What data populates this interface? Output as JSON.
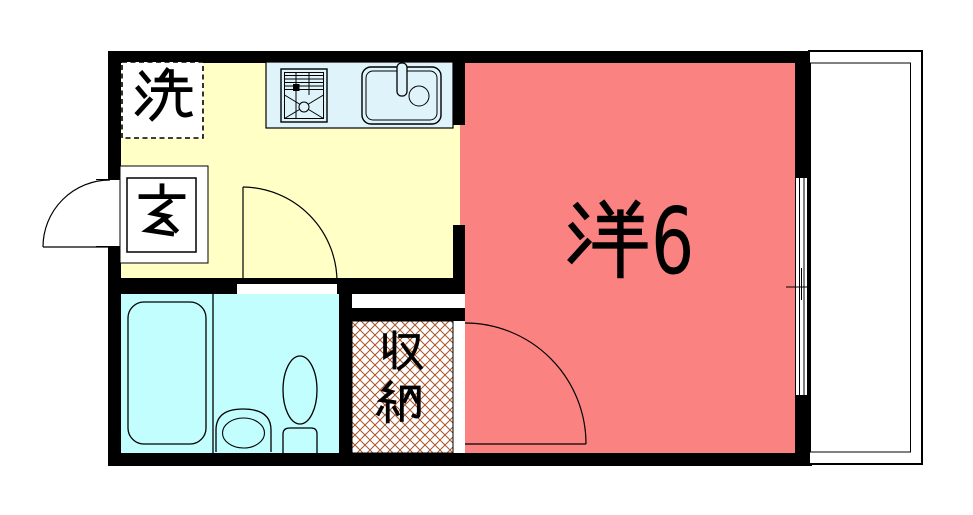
{
  "title": "1K apartment floor plan",
  "rooms": {
    "laundry": {
      "label": "洗"
    },
    "entrance": {
      "label": "玄"
    },
    "western_room": {
      "label": "洋6",
      "name_char": "洋",
      "size": "6"
    },
    "storage": {
      "label": "収納",
      "char_top": "収",
      "char_bottom": "納"
    },
    "kitchen": {
      "label": ""
    },
    "bathroom": {
      "label": ""
    },
    "balcony": {
      "label": ""
    }
  },
  "icons": [
    "stove-icon",
    "kitchen-sink-icon",
    "faucet-icon",
    "bathtub-icon",
    "washbasin-icon",
    "toilet-icon",
    "door-swing-icon",
    "window-icon"
  ],
  "colors": {
    "wall": "#000000",
    "kitchen_floor": "#FFFFC6",
    "room_floor": "#FA8280",
    "bath_floor": "#C2FEFE",
    "counter": "#DFF3FB",
    "hatch_line": "#A5552B",
    "background": "#FFFFFF",
    "line": "#000000"
  }
}
